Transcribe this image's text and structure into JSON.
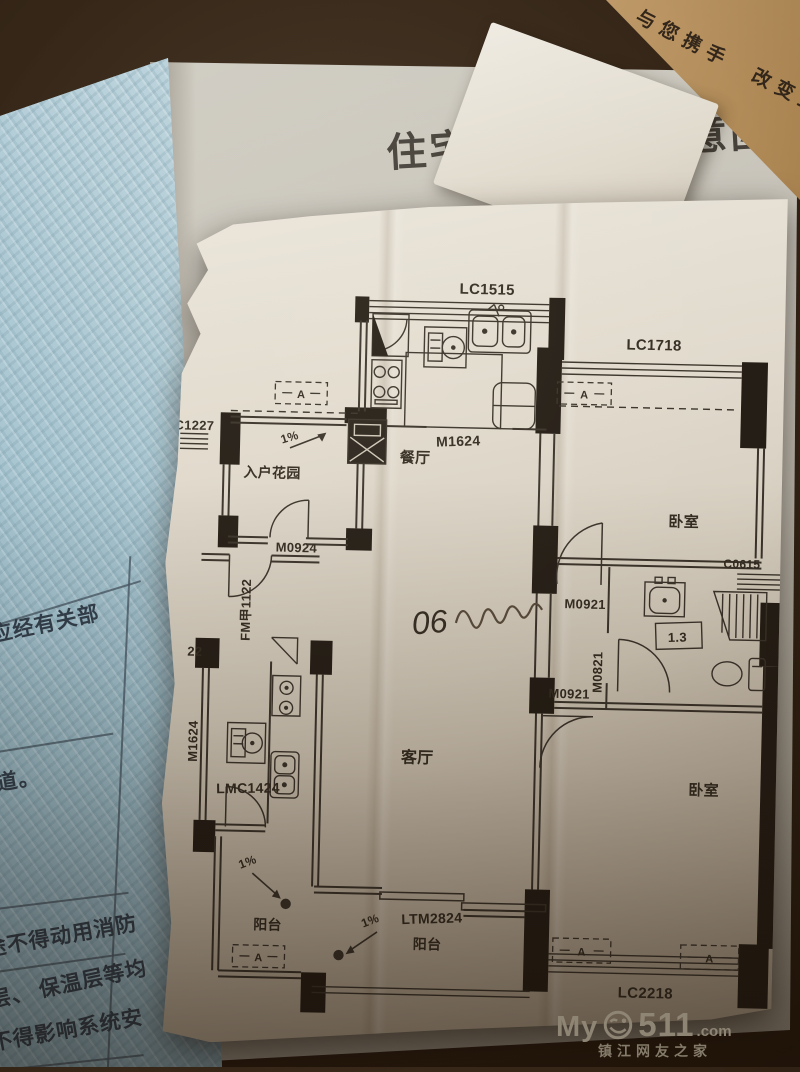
{
  "photo": {
    "slogan_strip": "与您携手　改变生",
    "watermark": {
      "my": "My",
      "num": "511",
      "dotcom": ".com",
      "tagline": "镇江网友之家"
    }
  },
  "booklet": {
    "page_title": "住宅结构平面示意图",
    "left_page": {
      "row1": "应经有关部",
      "row2": "道。",
      "row3": "途不得动用消防",
      "row4": "层、 保温层等均",
      "row5": "不得影响系统安"
    }
  },
  "plan": {
    "labels": {
      "lc1515": "LC1515",
      "lc1718": "LC1718",
      "c1227": "C1227",
      "c0615": "C0615",
      "lc2218": "LC2218",
      "m1624_top": "M1624",
      "m1624_left": "M1624",
      "m0924": "M0924",
      "fm1122": "FM甲1122",
      "m0921_top": "M0921",
      "m0921_mid": "M0921",
      "m0821": "M0821",
      "lmc1424": "LMC1424",
      "ltm2824": "LTM2824",
      "dining": "餐厅",
      "living": "客厅",
      "entry_garden": "入户花园",
      "bedroom_top": "卧室",
      "bedroom_bottom": "卧室",
      "balcony_left": "阳台",
      "balcony_bottom": "阳台",
      "slope_entry": "1%",
      "slope_left": "1%",
      "slope_bottom": "1%",
      "bath_note": "1.3",
      "num22": "22",
      "ac": "A",
      "handwriting": "06"
    }
  }
}
